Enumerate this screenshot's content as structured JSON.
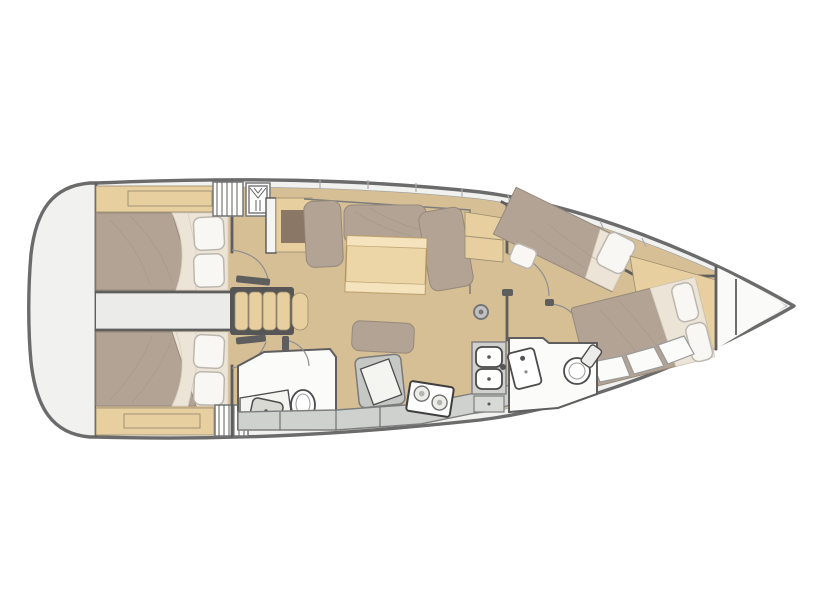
{
  "figure": {
    "kind": "sailing-yacht-interior-floor-plan",
    "view": "top-down deck plan",
    "bow_direction": "right",
    "double_berths_visible": 4,
    "heads_visible": 2
  },
  "colors": {
    "background": "#ffffff",
    "hull_outline": "#6b6b6b",
    "deck": "#f1f1ef",
    "inner_line": "#9c9c9c",
    "wall": "#5e5e5e",
    "floor_wood": "#d7bf95",
    "furniture_wood": "#e7cfa0",
    "table_wood": "#ecd6a8",
    "table_band": "#f4e3bc",
    "mattress": "#b2a395",
    "mattress_edge": "#96897b",
    "linen": "#ece4d7",
    "pillow": "#f8f7f4",
    "pillow_edge": "#bcb7ae",
    "corridor": "#ebebe9",
    "wet_floor": "#fbfbfa",
    "counter": "#ced1ce",
    "counter_edge": "#7d7d7d",
    "appliance": "#c6c8c5",
    "fixture_edge": "#4c4c4c",
    "tv_brown": "#8b7765",
    "steps_frame": "#565656",
    "arc": "#8f8f8f",
    "tick": "#ababab"
  },
  "rooms": {
    "hull": {
      "label": "Yacht hull, bow pointing right"
    },
    "aft_cabin_port": {
      "label": "Aft cabin port with double berth"
    },
    "aft_cabin_starboard": {
      "label": "Aft cabin starboard with double berth"
    },
    "corridor": {
      "label": "Aft corridor between cabins"
    },
    "companionway": {
      "label": "Companionway steps"
    },
    "salon": {
      "label": "Salon with sofa and folding table"
    },
    "nav_station": {
      "label": "Navigation station with chart table and seat"
    },
    "aft_head": {
      "label": "Aft head with toilet and washbasin"
    },
    "galley": {
      "label": "Galley with two-burner stove and double sink"
    },
    "forward_head": {
      "label": "Forward head with toilet and washbasin"
    },
    "forward_cabin_port": {
      "label": "Forward cabin port with angled double berth"
    },
    "forward_cabin_starboard": {
      "label": "Forward cabin starboard with island double berth"
    },
    "anchor_locker": {
      "label": "Bow anchor locker"
    }
  },
  "fixtures": {
    "mast": {
      "label": "Mast post"
    },
    "table": {
      "label": "Salon table"
    },
    "tv_locker": {
      "label": "Bulkhead locker / TV panel"
    },
    "sideboard": {
      "label": "Sideboard cabinet"
    },
    "stove": {
      "label": "Two-burner stove"
    },
    "double_sink": {
      "label": "Double galley sink"
    },
    "galley_locker": {
      "label": "Galley locker"
    },
    "toilet_aft": {
      "label": "Toilet, aft head"
    },
    "basin_aft": {
      "label": "Washbasin, aft head"
    },
    "toilet_fwd": {
      "label": "Toilet, forward head"
    },
    "basin_fwd": {
      "label": "Washbasin, forward head"
    },
    "hatch": {
      "label": "Cockpit hatch with vent symbol"
    },
    "ladder": {
      "label": "Slatted hatch / ladder"
    },
    "steps": {
      "label": "Companionway stair treads"
    },
    "doors": {
      "label": "Door swing arcs"
    },
    "bench": {
      "label": "Hull-side bench steps"
    }
  }
}
